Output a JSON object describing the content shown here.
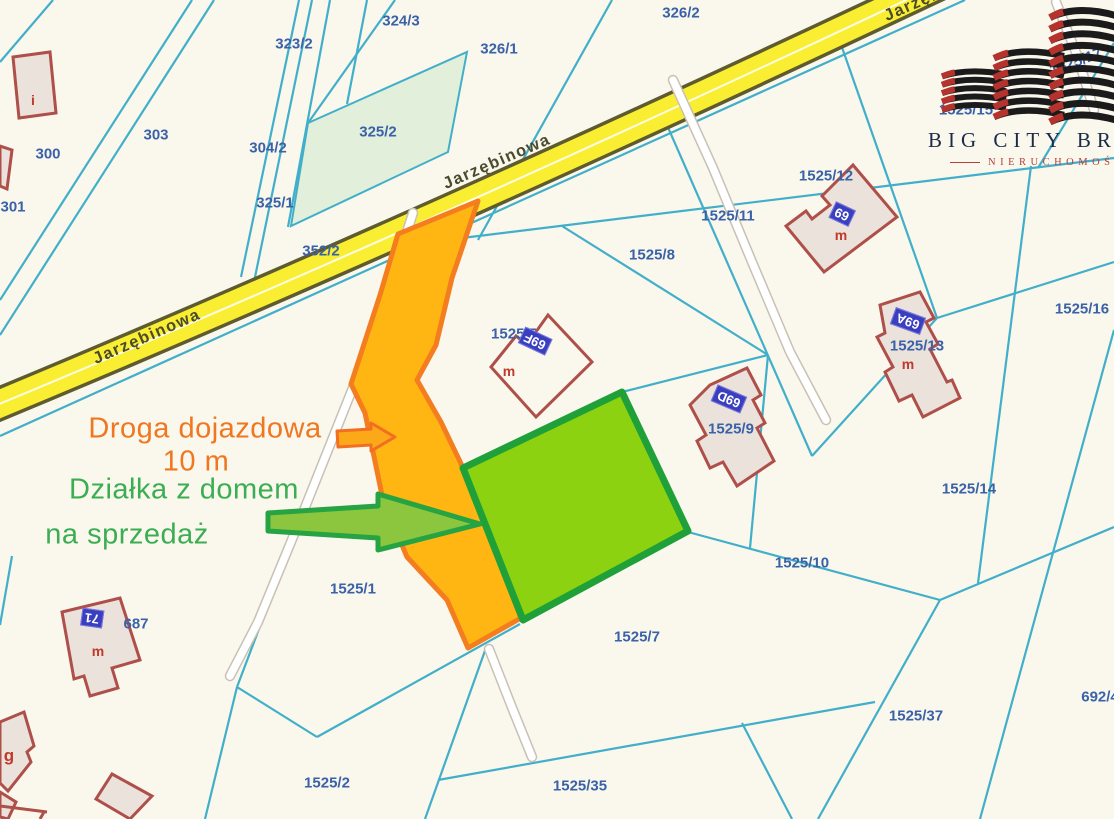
{
  "map": {
    "street_name": "Jarzębinowa",
    "labels": [
      {
        "t": "324/3",
        "x": 401,
        "y": 21,
        "c": "parcel"
      },
      {
        "t": "323/2",
        "x": 294,
        "y": 44,
        "c": "parcel"
      },
      {
        "t": "326/1",
        "x": 499,
        "y": 49,
        "c": "parcel"
      },
      {
        "t": "326/2",
        "x": 681,
        "y": 13,
        "c": "parcel"
      },
      {
        "t": "303",
        "x": 156,
        "y": 135,
        "c": "parcel"
      },
      {
        "t": "300",
        "x": 48,
        "y": 154,
        "c": "parcel"
      },
      {
        "t": "301",
        "x": 13,
        "y": 207,
        "c": "parcel"
      },
      {
        "t": "304/2",
        "x": 268,
        "y": 148,
        "c": "parcel"
      },
      {
        "t": "325/2",
        "x": 378,
        "y": 132,
        "c": "parcel"
      },
      {
        "t": "325/1",
        "x": 275,
        "y": 203,
        "c": "parcel"
      },
      {
        "t": "352/2",
        "x": 321,
        "y": 251,
        "c": "parcel"
      },
      {
        "t": "1525/15",
        "x": 966,
        "y": 110,
        "c": "parcel"
      },
      {
        "t": "1525/17",
        "x": 1076,
        "y": 62,
        "c": "parcel",
        "r": -20
      },
      {
        "t": "1525/12",
        "x": 826,
        "y": 176,
        "c": "parcel"
      },
      {
        "t": "1525/11",
        "x": 728,
        "y": 216,
        "c": "parcel"
      },
      {
        "t": "1525/8",
        "x": 652,
        "y": 255,
        "c": "parcel"
      },
      {
        "t": "1525/5",
        "x": 514,
        "y": 334,
        "c": "parcel"
      },
      {
        "t": "1525/9",
        "x": 731,
        "y": 429,
        "c": "parcel"
      },
      {
        "t": "1525/13",
        "x": 917,
        "y": 346,
        "c": "parcel"
      },
      {
        "t": "1525/16",
        "x": 1082,
        "y": 309,
        "c": "parcel"
      },
      {
        "t": "1525/14",
        "x": 969,
        "y": 489,
        "c": "parcel"
      },
      {
        "t": "1525/10",
        "x": 802,
        "y": 563,
        "c": "parcel"
      },
      {
        "t": "1525/7",
        "x": 637,
        "y": 637,
        "c": "parcel"
      },
      {
        "t": "1525/1",
        "x": 353,
        "y": 589,
        "c": "parcel"
      },
      {
        "t": "1525/2",
        "x": 327,
        "y": 783,
        "c": "parcel"
      },
      {
        "t": "1525/35",
        "x": 580,
        "y": 786,
        "c": "parcel"
      },
      {
        "t": "1525/37",
        "x": 916,
        "y": 716,
        "c": "parcel"
      },
      {
        "t": "692/4",
        "x": 1100,
        "y": 697,
        "c": "parcel"
      },
      {
        "t": "687",
        "x": 136,
        "y": 624,
        "c": "parcel"
      },
      {
        "t": "Jarzębinowa",
        "x": 147,
        "y": 337,
        "c": "street",
        "r": -23.5
      },
      {
        "t": "Jarzębinowa",
        "x": 497,
        "y": 162,
        "c": "street",
        "r": -23.5
      },
      {
        "t": "Jarzębinowa",
        "x": 938,
        "y": -6,
        "c": "street",
        "r": -23.5
      },
      {
        "t": "69",
        "x": 842,
        "y": 214,
        "c": "badge",
        "r": 205
      },
      {
        "t": "69F",
        "x": 535,
        "y": 341,
        "c": "badge",
        "r": 205
      },
      {
        "t": "69D",
        "x": 729,
        "y": 399,
        "c": "badge",
        "r": 203
      },
      {
        "t": "69A",
        "x": 908,
        "y": 321,
        "c": "badge",
        "r": 200
      },
      {
        "t": "71",
        "x": 92,
        "y": 618,
        "c": "badge",
        "r": 188
      },
      {
        "t": "m",
        "x": 841,
        "y": 235,
        "c": "mlabel"
      },
      {
        "t": "m",
        "x": 509,
        "y": 371,
        "c": "mlabel"
      },
      {
        "t": "m",
        "x": 908,
        "y": 364,
        "c": "mlabel"
      },
      {
        "t": "m",
        "x": 98,
        "y": 651,
        "c": "mlabel"
      },
      {
        "t": "i",
        "x": 33,
        "y": 100,
        "c": "mlabel"
      },
      {
        "t": "g",
        "x": 9,
        "y": 756,
        "c": "glabel"
      }
    ]
  },
  "annotations": {
    "access_road_line1": "Droga dojazdowa",
    "access_road_line2": "10 m",
    "plot_line1": "Działka z domem",
    "plot_line2": "na sprzedaż"
  },
  "logo": {
    "title": "BIG CITY BROKER",
    "subtitle": "NIERUCHOMOŚCI"
  },
  "colors": {
    "background": "#FAF7ED",
    "parcel_line_teal": "#41AFC9",
    "parcel_text_navy": "#3A62A8",
    "street_yellow": "#F9EE32",
    "street_casing": "#5E5B2E",
    "access_road_orange_fill": "#FFB612",
    "access_road_orange_stroke": "#F47D20",
    "plot_green_fill": "#8CD211",
    "plot_green_stroke": "#1FA038",
    "tinted_parcel_green": "#E2EFDA",
    "building_stroke_red": "#AE4F49",
    "building_fill": "#EAE2DB",
    "house_number_badge_blue": "#3A3FBF",
    "annotation_orange": "#F0761F",
    "annotation_green": "#3BAE54",
    "logo_navy": "#1C2B47",
    "logo_red": "#B5413C"
  }
}
